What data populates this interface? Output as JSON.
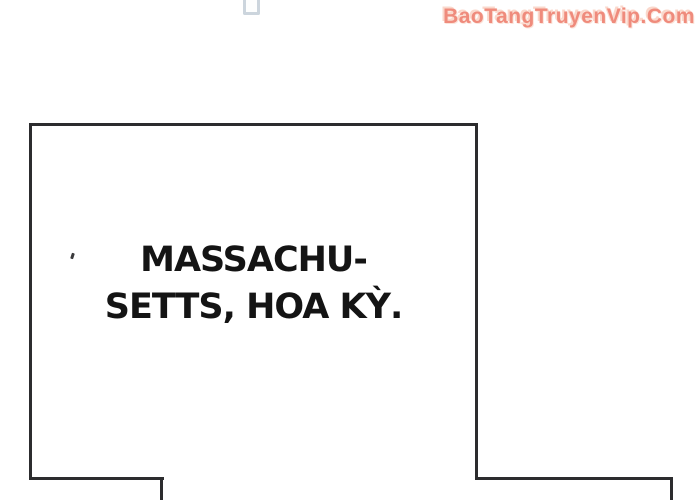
{
  "watermark": {
    "label": "BaoTangTruyenVip.Com",
    "color": "#ef8b7c"
  },
  "panel": {
    "caption_lines": [
      "MASSACHU-",
      "SETTS, HOA KỲ."
    ],
    "border_color": "#2c2c2e",
    "text_color": "#141414"
  },
  "decor": {
    "top_object": "cutoff-light-blue-object",
    "speck": "tiny-ink-mark"
  }
}
